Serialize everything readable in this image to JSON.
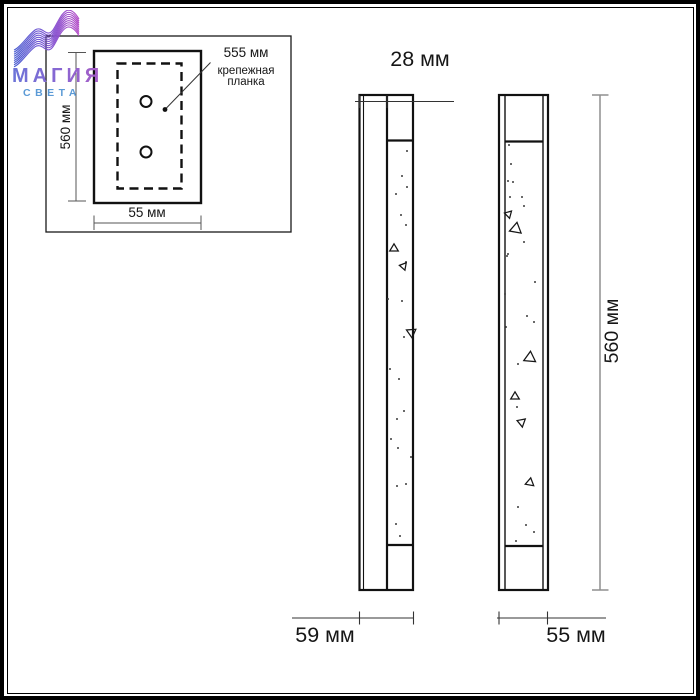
{
  "logo": {
    "title": "МАГИЯ",
    "subtitle": "СВЕТА",
    "wave_gradient": [
      "#4b5fd1",
      "#7b55d3",
      "#b44cc7"
    ],
    "title_gradient": [
      "#6b74d8",
      "#a95cc5"
    ],
    "subtitle_color": "#5b9ad6"
  },
  "detail_box": {
    "bracket_length_label": "555 мм",
    "part_name_line1": "крепежная",
    "part_name_line2": "планка",
    "height_label": "560 мм",
    "width_label": "55 мм"
  },
  "side_view": {
    "depth_top_label": "28 мм",
    "depth_bottom_label": "59 мм"
  },
  "front_view": {
    "width_label": "55 мм",
    "height_label": "560 мм"
  },
  "colors": {
    "line": "#1a1a1a",
    "dim_gray": "#8f8f8f"
  },
  "texture": {
    "side_dots": [
      [
        403,
        147
      ],
      [
        398,
        172
      ],
      [
        403,
        183
      ],
      [
        392,
        190
      ],
      [
        397,
        211
      ],
      [
        402,
        221
      ],
      [
        402,
        258
      ],
      [
        384,
        295
      ],
      [
        398,
        297
      ],
      [
        400,
        333
      ],
      [
        386,
        365
      ],
      [
        395,
        375
      ],
      [
        400,
        407
      ],
      [
        393,
        415
      ],
      [
        387,
        435
      ],
      [
        394,
        444
      ],
      [
        407,
        453
      ],
      [
        402,
        480
      ],
      [
        393,
        482
      ],
      [
        392,
        520
      ],
      [
        396,
        532
      ]
    ],
    "side_triangles": [
      [
        390,
        244,
        8,
        0
      ],
      [
        399,
        262,
        7,
        -80
      ],
      [
        408,
        328,
        9,
        55
      ]
    ],
    "front_dots": [
      [
        505,
        141
      ],
      [
        507,
        160
      ],
      [
        504,
        177
      ],
      [
        509,
        178
      ],
      [
        506,
        193
      ],
      [
        518,
        193
      ],
      [
        520,
        202
      ],
      [
        520,
        238
      ],
      [
        504,
        250
      ],
      [
        503,
        252
      ],
      [
        531,
        278
      ],
      [
        501,
        290
      ],
      [
        523,
        312
      ],
      [
        530,
        318
      ],
      [
        502,
        323
      ],
      [
        514,
        360
      ],
      [
        513,
        403
      ],
      [
        514,
        503
      ],
      [
        522,
        521
      ],
      [
        530,
        528
      ],
      [
        512,
        537
      ]
    ],
    "front_triangles": [
      [
        504,
        210,
        7,
        -75
      ],
      [
        512,
        224,
        11,
        10
      ],
      [
        526,
        353,
        11,
        5
      ],
      [
        511,
        392,
        8,
        0
      ],
      [
        517,
        418,
        8,
        -70
      ],
      [
        526,
        478,
        8,
        10
      ]
    ]
  }
}
